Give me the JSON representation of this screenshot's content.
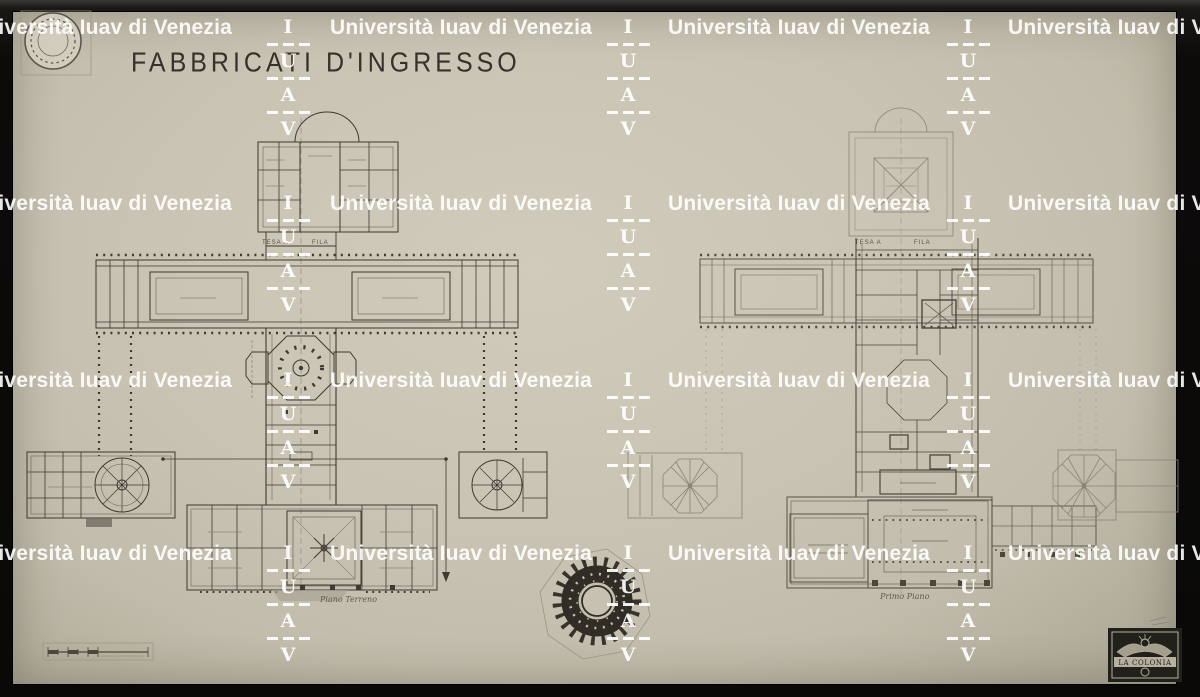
{
  "document": {
    "title": "FABBRICATI D'INGRESSO",
    "plans": {
      "left": {
        "caption": "Piano Terreno",
        "axis_label_left": "TESA A",
        "axis_label_right": "FILA"
      },
      "right": {
        "caption": "Primo Piano",
        "axis_label_left": "TESA A",
        "axis_label_right": "FILA"
      }
    },
    "publisher_stamp": "LA COLONIA"
  },
  "watermark": {
    "text": "Università Iuav di Venezia",
    "acronym_letters": [
      "I",
      "U",
      "A",
      "V"
    ],
    "color": "#ffffff"
  },
  "colors": {
    "frame": "#11100d",
    "paper": "#c9c4b4",
    "ink": "#3c3a31",
    "faint_ink": "#8a8477"
  }
}
